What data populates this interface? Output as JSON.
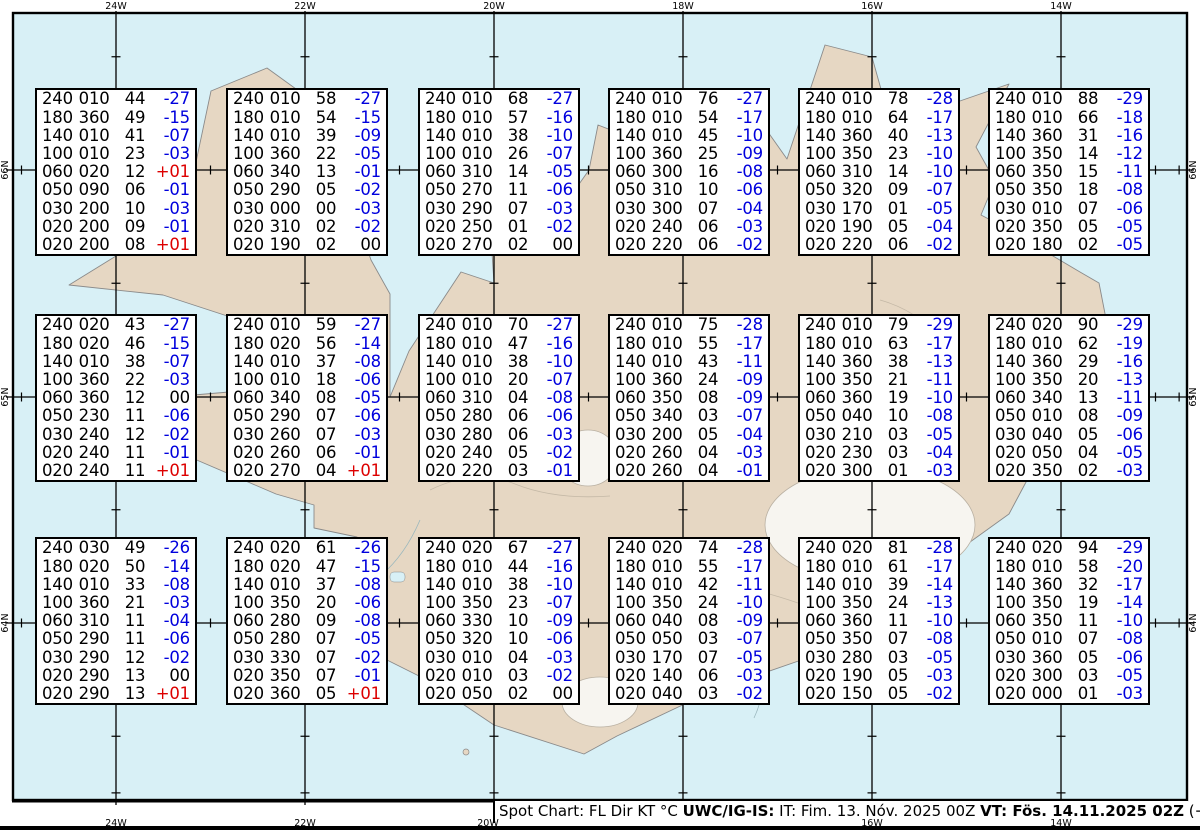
{
  "axes": {
    "top": [
      "24W",
      "22W",
      "20W",
      "18W",
      "16W",
      "14W"
    ],
    "bottom": [
      "24W",
      "22W",
      "20W",
      "16W",
      "14W"
    ],
    "left": [
      "66N",
      "65N",
      "64N"
    ],
    "right": [
      "66N",
      "65N",
      "64N"
    ]
  },
  "caption": {
    "segments": [
      {
        "text": "Spot Chart: FL Dir KT °C ",
        "bold": false
      },
      {
        "text": "UWC/IG-IS:",
        "bold": true
      },
      {
        "text": " IT: Fim. 13. Nóv. 2025 00Z ",
        "bold": false
      },
      {
        "text": "VT: Fös. 14.11.2025 02Z",
        "bold": true
      },
      {
        "text": " (+26 h)",
        "bold": false
      }
    ]
  },
  "colors": {
    "ocean": "#d8f0f6",
    "land": "#e6d7c3",
    "glacier": "#f7f5f0",
    "coastline": "#8a8a8a",
    "grid": "#000000",
    "temp_negative": "#0000dd",
    "temp_positive": "#dd0000"
  },
  "spot_boxes": [
    {
      "rows": [
        [
          "240",
          "010",
          "44",
          "-27"
        ],
        [
          "180",
          "360",
          "49",
          "-15"
        ],
        [
          "140",
          "010",
          "41",
          "-07"
        ],
        [
          "100",
          "010",
          "23",
          "-03"
        ],
        [
          "060",
          "020",
          "12",
          "+01"
        ],
        [
          "050",
          "090",
          "06",
          "-01"
        ],
        [
          "030",
          "200",
          "10",
          "-03"
        ],
        [
          "020",
          "200",
          "09",
          "-01"
        ],
        [
          "020",
          "200",
          "08",
          "+01"
        ]
      ]
    },
    {
      "rows": [
        [
          "240",
          "010",
          "58",
          "-27"
        ],
        [
          "180",
          "010",
          "54",
          "-15"
        ],
        [
          "140",
          "010",
          "39",
          "-09"
        ],
        [
          "100",
          "360",
          "22",
          "-05"
        ],
        [
          "060",
          "340",
          "13",
          "-01"
        ],
        [
          "050",
          "290",
          "05",
          "-02"
        ],
        [
          "030",
          "000",
          "00",
          "-03"
        ],
        [
          "020",
          "310",
          "02",
          "-02"
        ],
        [
          "020",
          "190",
          "02",
          "00"
        ]
      ]
    },
    {
      "rows": [
        [
          "240",
          "010",
          "68",
          "-27"
        ],
        [
          "180",
          "010",
          "57",
          "-16"
        ],
        [
          "140",
          "010",
          "38",
          "-10"
        ],
        [
          "100",
          "010",
          "26",
          "-07"
        ],
        [
          "060",
          "310",
          "14",
          "-05"
        ],
        [
          "050",
          "270",
          "11",
          "-06"
        ],
        [
          "030",
          "290",
          "07",
          "-03"
        ],
        [
          "020",
          "250",
          "01",
          "-02"
        ],
        [
          "020",
          "270",
          "02",
          "00"
        ]
      ]
    },
    {
      "rows": [
        [
          "240",
          "010",
          "76",
          "-27"
        ],
        [
          "180",
          "010",
          "54",
          "-17"
        ],
        [
          "140",
          "010",
          "45",
          "-10"
        ],
        [
          "100",
          "360",
          "25",
          "-09"
        ],
        [
          "060",
          "300",
          "16",
          "-08"
        ],
        [
          "050",
          "310",
          "10",
          "-06"
        ],
        [
          "030",
          "300",
          "07",
          "-04"
        ],
        [
          "020",
          "240",
          "06",
          "-03"
        ],
        [
          "020",
          "220",
          "06",
          "-02"
        ]
      ]
    },
    {
      "rows": [
        [
          "240",
          "010",
          "78",
          "-28"
        ],
        [
          "180",
          "010",
          "64",
          "-17"
        ],
        [
          "140",
          "360",
          "40",
          "-13"
        ],
        [
          "100",
          "350",
          "23",
          "-10"
        ],
        [
          "060",
          "310",
          "14",
          "-10"
        ],
        [
          "050",
          "320",
          "09",
          "-07"
        ],
        [
          "030",
          "170",
          "01",
          "-05"
        ],
        [
          "020",
          "190",
          "05",
          "-04"
        ],
        [
          "020",
          "220",
          "06",
          "-02"
        ]
      ]
    },
    {
      "rows": [
        [
          "240",
          "010",
          "88",
          "-29"
        ],
        [
          "180",
          "010",
          "66",
          "-18"
        ],
        [
          "140",
          "360",
          "31",
          "-16"
        ],
        [
          "100",
          "350",
          "14",
          "-12"
        ],
        [
          "060",
          "350",
          "15",
          "-11"
        ],
        [
          "050",
          "350",
          "18",
          "-08"
        ],
        [
          "030",
          "010",
          "07",
          "-06"
        ],
        [
          "020",
          "350",
          "05",
          "-05"
        ],
        [
          "020",
          "180",
          "02",
          "-05"
        ]
      ]
    },
    {
      "rows": [
        [
          "240",
          "020",
          "43",
          "-27"
        ],
        [
          "180",
          "020",
          "46",
          "-15"
        ],
        [
          "140",
          "010",
          "38",
          "-07"
        ],
        [
          "100",
          "360",
          "22",
          "-03"
        ],
        [
          "060",
          "360",
          "12",
          "00"
        ],
        [
          "050",
          "230",
          "11",
          "-06"
        ],
        [
          "030",
          "240",
          "12",
          "-02"
        ],
        [
          "020",
          "240",
          "11",
          "-01"
        ],
        [
          "020",
          "240",
          "11",
          "+01"
        ]
      ]
    },
    {
      "rows": [
        [
          "240",
          "010",
          "59",
          "-27"
        ],
        [
          "180",
          "020",
          "56",
          "-14"
        ],
        [
          "140",
          "010",
          "37",
          "-08"
        ],
        [
          "100",
          "010",
          "18",
          "-06"
        ],
        [
          "060",
          "340",
          "08",
          "-05"
        ],
        [
          "050",
          "290",
          "07",
          "-06"
        ],
        [
          "030",
          "260",
          "07",
          "-03"
        ],
        [
          "020",
          "260",
          "06",
          "-01"
        ],
        [
          "020",
          "270",
          "04",
          "+01"
        ]
      ]
    },
    {
      "rows": [
        [
          "240",
          "010",
          "70",
          "-27"
        ],
        [
          "180",
          "010",
          "47",
          "-16"
        ],
        [
          "140",
          "010",
          "38",
          "-10"
        ],
        [
          "100",
          "010",
          "20",
          "-07"
        ],
        [
          "060",
          "310",
          "04",
          "-08"
        ],
        [
          "050",
          "280",
          "06",
          "-06"
        ],
        [
          "030",
          "280",
          "06",
          "-03"
        ],
        [
          "020",
          "240",
          "05",
          "-02"
        ],
        [
          "020",
          "220",
          "03",
          "-01"
        ]
      ]
    },
    {
      "rows": [
        [
          "240",
          "010",
          "75",
          "-28"
        ],
        [
          "180",
          "010",
          "55",
          "-17"
        ],
        [
          "140",
          "010",
          "43",
          "-11"
        ],
        [
          "100",
          "360",
          "24",
          "-09"
        ],
        [
          "060",
          "350",
          "08",
          "-09"
        ],
        [
          "050",
          "340",
          "03",
          "-07"
        ],
        [
          "030",
          "200",
          "05",
          "-04"
        ],
        [
          "020",
          "260",
          "04",
          "-03"
        ],
        [
          "020",
          "260",
          "04",
          "-01"
        ]
      ]
    },
    {
      "rows": [
        [
          "240",
          "010",
          "79",
          "-29"
        ],
        [
          "180",
          "010",
          "63",
          "-17"
        ],
        [
          "140",
          "360",
          "38",
          "-13"
        ],
        [
          "100",
          "350",
          "21",
          "-11"
        ],
        [
          "060",
          "360",
          "19",
          "-10"
        ],
        [
          "050",
          "040",
          "10",
          "-08"
        ],
        [
          "030",
          "210",
          "03",
          "-05"
        ],
        [
          "020",
          "230",
          "03",
          "-04"
        ],
        [
          "020",
          "300",
          "01",
          "-03"
        ]
      ]
    },
    {
      "rows": [
        [
          "240",
          "020",
          "90",
          "-29"
        ],
        [
          "180",
          "010",
          "62",
          "-19"
        ],
        [
          "140",
          "360",
          "29",
          "-16"
        ],
        [
          "100",
          "350",
          "20",
          "-13"
        ],
        [
          "060",
          "340",
          "13",
          "-11"
        ],
        [
          "050",
          "010",
          "08",
          "-09"
        ],
        [
          "030",
          "040",
          "05",
          "-06"
        ],
        [
          "020",
          "050",
          "04",
          "-05"
        ],
        [
          "020",
          "350",
          "02",
          "-03"
        ]
      ]
    },
    {
      "rows": [
        [
          "240",
          "030",
          "49",
          "-26"
        ],
        [
          "180",
          "020",
          "50",
          "-14"
        ],
        [
          "140",
          "010",
          "33",
          "-08"
        ],
        [
          "100",
          "360",
          "21",
          "-03"
        ],
        [
          "060",
          "310",
          "11",
          "-04"
        ],
        [
          "050",
          "290",
          "11",
          "-06"
        ],
        [
          "030",
          "290",
          "12",
          "-02"
        ],
        [
          "020",
          "290",
          "13",
          "00"
        ],
        [
          "020",
          "290",
          "13",
          "+01"
        ]
      ]
    },
    {
      "rows": [
        [
          "240",
          "020",
          "61",
          "-26"
        ],
        [
          "180",
          "020",
          "47",
          "-15"
        ],
        [
          "140",
          "010",
          "37",
          "-08"
        ],
        [
          "100",
          "350",
          "20",
          "-06"
        ],
        [
          "060",
          "280",
          "09",
          "-08"
        ],
        [
          "050",
          "280",
          "07",
          "-05"
        ],
        [
          "030",
          "330",
          "07",
          "-02"
        ],
        [
          "020",
          "350",
          "07",
          "-01"
        ],
        [
          "020",
          "360",
          "05",
          "+01"
        ]
      ]
    },
    {
      "rows": [
        [
          "240",
          "020",
          "67",
          "-27"
        ],
        [
          "180",
          "010",
          "44",
          "-16"
        ],
        [
          "140",
          "010",
          "38",
          "-10"
        ],
        [
          "100",
          "350",
          "23",
          "-07"
        ],
        [
          "060",
          "330",
          "10",
          "-09"
        ],
        [
          "050",
          "320",
          "10",
          "-06"
        ],
        [
          "030",
          "010",
          "04",
          "-03"
        ],
        [
          "020",
          "010",
          "03",
          "-02"
        ],
        [
          "020",
          "050",
          "02",
          "00"
        ]
      ]
    },
    {
      "rows": [
        [
          "240",
          "020",
          "74",
          "-28"
        ],
        [
          "180",
          "010",
          "55",
          "-17"
        ],
        [
          "140",
          "010",
          "42",
          "-11"
        ],
        [
          "100",
          "350",
          "24",
          "-10"
        ],
        [
          "060",
          "040",
          "08",
          "-09"
        ],
        [
          "050",
          "050",
          "03",
          "-07"
        ],
        [
          "030",
          "170",
          "07",
          "-05"
        ],
        [
          "020",
          "140",
          "06",
          "-03"
        ],
        [
          "020",
          "040",
          "03",
          "-02"
        ]
      ]
    },
    {
      "rows": [
        [
          "240",
          "020",
          "81",
          "-28"
        ],
        [
          "180",
          "010",
          "61",
          "-17"
        ],
        [
          "140",
          "010",
          "39",
          "-14"
        ],
        [
          "100",
          "350",
          "24",
          "-13"
        ],
        [
          "060",
          "360",
          "11",
          "-10"
        ],
        [
          "050",
          "350",
          "07",
          "-08"
        ],
        [
          "030",
          "280",
          "03",
          "-05"
        ],
        [
          "020",
          "190",
          "05",
          "-03"
        ],
        [
          "020",
          "150",
          "05",
          "-02"
        ]
      ]
    },
    {
      "rows": [
        [
          "240",
          "020",
          "94",
          "-29"
        ],
        [
          "180",
          "010",
          "58",
          "-20"
        ],
        [
          "140",
          "360",
          "32",
          "-17"
        ],
        [
          "100",
          "350",
          "19",
          "-14"
        ],
        [
          "060",
          "350",
          "11",
          "-10"
        ],
        [
          "050",
          "010",
          "07",
          "-08"
        ],
        [
          "030",
          "360",
          "05",
          "-06"
        ],
        [
          "020",
          "300",
          "03",
          "-05"
        ],
        [
          "020",
          "000",
          "01",
          "-03"
        ]
      ]
    }
  ]
}
